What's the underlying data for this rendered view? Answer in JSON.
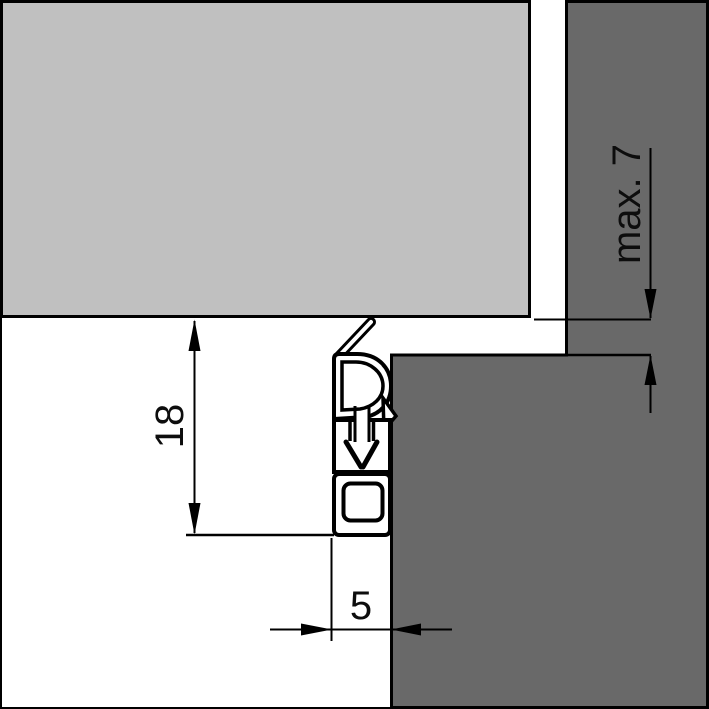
{
  "drawing": {
    "dimension_labels": {
      "profile_height": "18",
      "gap": "max. 7",
      "profile_depth": "5"
    },
    "colors": {
      "door_panel": "#c0c0c0",
      "frame": "#696969",
      "line": "#000000",
      "background": "#ffffff",
      "profile": "#ffffff"
    }
  }
}
